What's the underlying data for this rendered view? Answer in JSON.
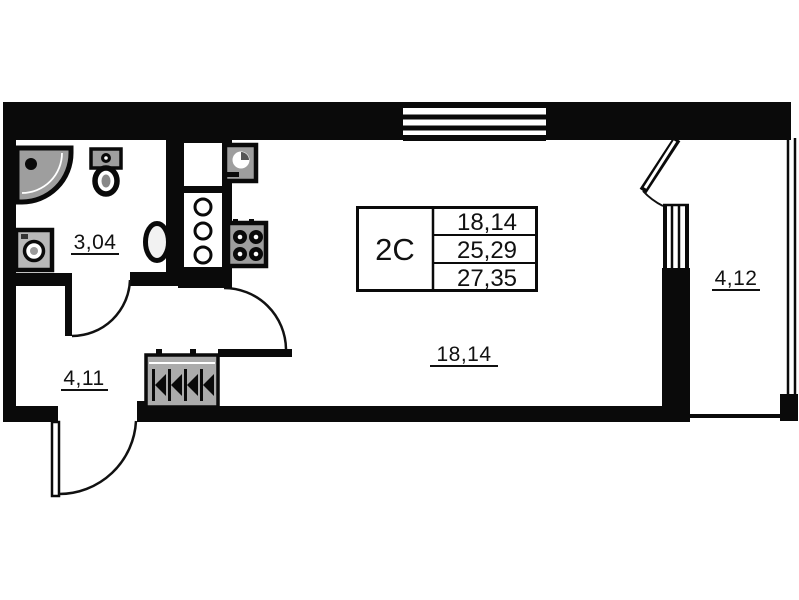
{
  "plan": {
    "stamp": {
      "unit": "2С",
      "areas": [
        "18,14",
        "25,29",
        "27,35"
      ]
    },
    "rooms": {
      "bathroom": {
        "area": "3,04"
      },
      "hallway": {
        "area": "4,11"
      },
      "living": {
        "area": "18,14"
      },
      "balcony": {
        "area": "4,12"
      }
    }
  },
  "colors": {
    "wall": "#0a0a0a",
    "background": "#ffffff",
    "fixture": "#9e9e9e",
    "washer": "#b8b8b8",
    "wardrobe": "#ababab",
    "line": "#111111"
  },
  "icons": {
    "shower": "shower-tray-icon",
    "toilet": "toilet-icon",
    "washing_machine": "washing-machine-icon",
    "bathroom_sink": "sink-icon",
    "kitchen_sink": "kitchen-sink-icon",
    "stove": "stove-burners-icon",
    "wardrobe": "wardrobe-hangers-icon",
    "window": "window-symbol",
    "door": "door-swing-arc"
  }
}
